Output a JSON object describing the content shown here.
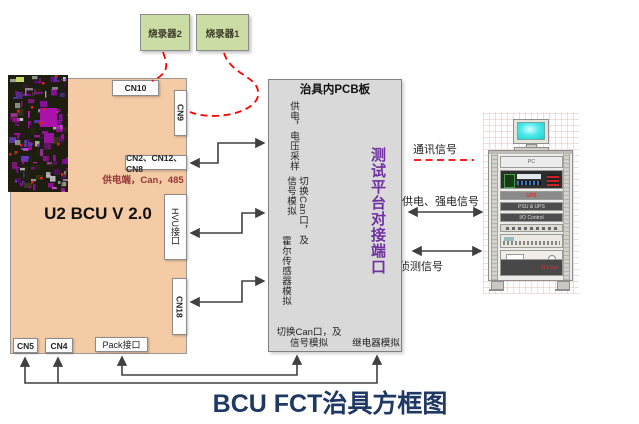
{
  "diagram_title": "BCU FCT治具方框图",
  "programmers": {
    "p2": "烧录器2",
    "p1": "烧录器1"
  },
  "bcu": {
    "name": "U2 BCU V 2.0",
    "cn10": "CN10",
    "cn9": "CN9",
    "cn2_group": "CN2、CN12、CN8",
    "power_note": "供电端，Can，485",
    "hvu": "HVU接口",
    "cn18": "CN18",
    "cn5": "CN5",
    "cn4": "CN4",
    "pack": "Pack接口"
  },
  "fixture": {
    "title": "治具内PCB板",
    "power_sampling": "供电，电压采样",
    "can_switch_line1": "切换Can口，及",
    "can_switch_line2": "信号模拟",
    "hall_sim": "霍尔传感器模拟",
    "can_switch_bottom_line1": "切换Can口，及",
    "can_switch_bottom_line2": "信号模拟",
    "relay_sim": "继电器模拟",
    "port": "测试平台对接端口"
  },
  "signals": {
    "comm": "通讯信号",
    "power_strong": "供电、强电信号",
    "detect": "侦测信号"
  },
  "rack": {
    "pc": "PC",
    "ups": "UPS",
    "psu": "PSU & UPS",
    "io": "I/O Control",
    "rload": "R Load"
  },
  "colors": {
    "title_navy": "#1F3864",
    "port_purple": "#7030A0",
    "dashed_red": "#FF0000",
    "power_note_red": "#953735",
    "bcu_fill": "#F4CBA5",
    "fixture_fill": "#D9D9D9",
    "programmer_fill": "#CBDCA4"
  }
}
